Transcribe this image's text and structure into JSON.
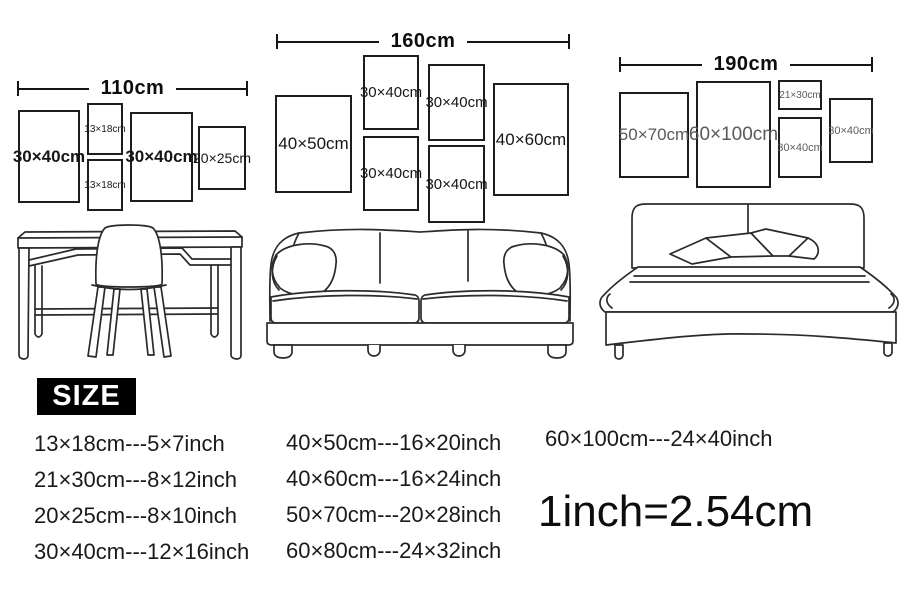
{
  "scenes": [
    {
      "furniture": "desk-and-chair",
      "width_label": "110cm",
      "frames": [
        "30×40cm",
        "13×18cm",
        "13×18cm",
        "30×40cm",
        "20×25cm"
      ]
    },
    {
      "furniture": "sofa",
      "width_label": "160cm",
      "frames": [
        "40×50cm",
        "30×40cm",
        "30×40cm",
        "30×40cm",
        "30×40cm",
        "40×60cm"
      ]
    },
    {
      "furniture": "bed",
      "width_label": "190cm",
      "frames": [
        "50×70cm",
        "60×100cm",
        "21×30cm",
        "30×40cm",
        "30×40cm"
      ]
    }
  ],
  "size_table": {
    "title": "SIZE",
    "columns": [
      [
        "13×18cm---5×7inch",
        "21×30cm---8×12inch",
        "20×25cm---8×10inch",
        "30×40cm---12×16inch"
      ],
      [
        "40×50cm---16×20inch",
        "40×60cm---16×24inch",
        "50×70cm---20×28inch",
        "60×80cm---24×32inch"
      ],
      [
        "60×100cm---24×40inch"
      ]
    ],
    "conversion": "1inch=2.54cm"
  },
  "colors": {
    "ink": "#1d1d1d",
    "muted_label": "#5a5a5a",
    "badge_bg": "#000000",
    "badge_text": "#ffffff",
    "background": "#ffffff"
  }
}
